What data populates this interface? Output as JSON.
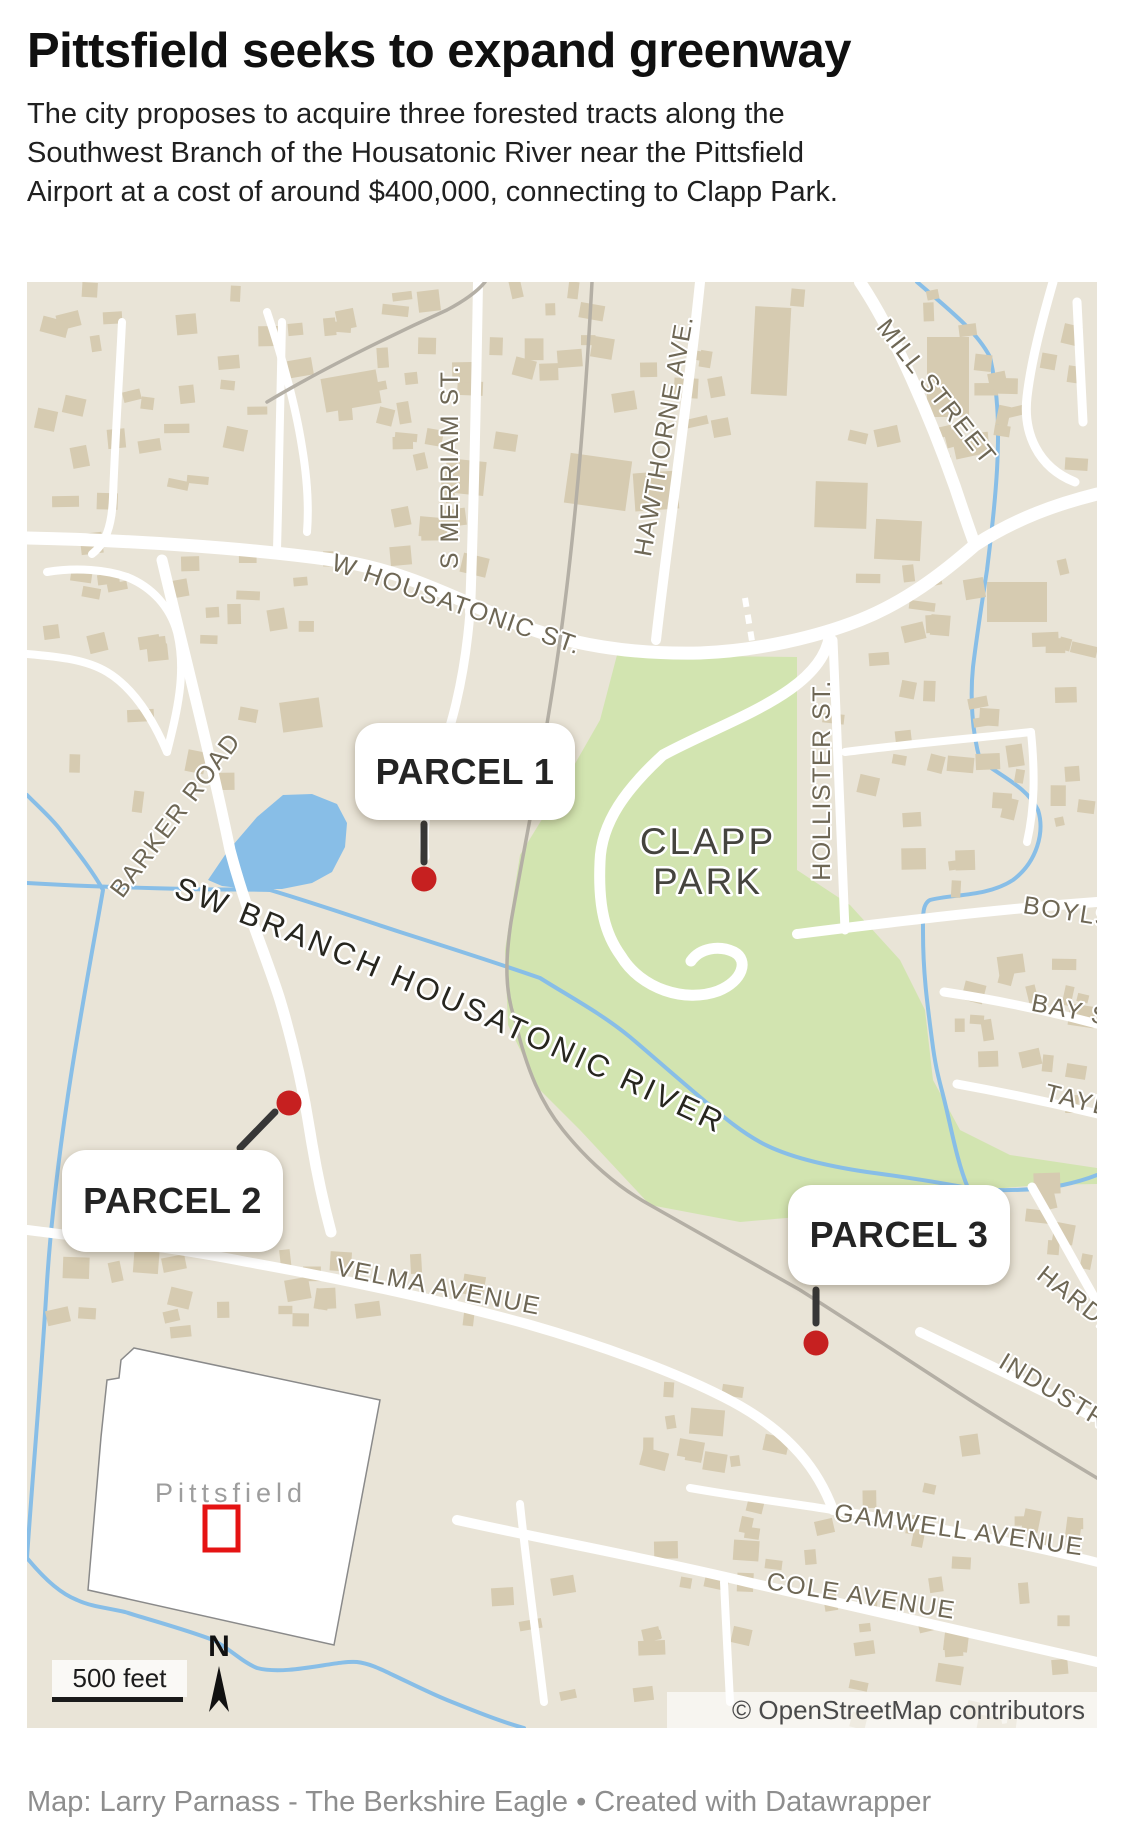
{
  "header": {
    "title": "Pittsfield seeks to expand greenway",
    "subtitle_lines": [
      "The city proposes to acquire three forested tracts along the",
      "Southwest Branch of the Housatonic River near the Pittsfield",
      "Airport at a cost of around $400,000, connecting to Clapp Park."
    ]
  },
  "map": {
    "street_labels": {
      "w_housatonic": "W HOUSATONIC ST.",
      "s_merriam": "S MERRIAM ST.",
      "hawthorne": "HAWTHORNE AVE.",
      "mill": "MILL STREET",
      "barker": "BARKER ROAD",
      "hollister": "HOLLISTER ST.",
      "boylston": "BOYLS",
      "bay": "BAY S",
      "taylor": "TAYL",
      "harding": "HARDI",
      "industrial": "INDUSTRI",
      "velma": "VELMA AVENUE",
      "gamwell": "GAMWELL AVENUE",
      "cole": "COLE AVENUE"
    },
    "area_labels": {
      "park_line1": "CLAPP",
      "park_line2": "PARK",
      "river": "SW BRANCH HOUSATONIC RIVER"
    },
    "parcels": [
      {
        "label": "PARCEL 1"
      },
      {
        "label": "PARCEL 2"
      },
      {
        "label": "PARCEL 3"
      }
    ],
    "inset": {
      "city_label": "Pittsfield"
    },
    "scale": {
      "label": "500 feet"
    },
    "compass": {
      "label": "N"
    },
    "attribution": "© OpenStreetMap contributors",
    "colors": {
      "map_background": "#e9e4d7",
      "building": "#d6cbb1",
      "park_green": "#d2e4b0",
      "water_blue": "#88bee7",
      "road_white": "#ffffff",
      "railroad_gray": "#b4afa5",
      "street_label": "#6e6755",
      "parcel_dot_red": "#c62020",
      "inset_marker_red": "#e51313"
    }
  },
  "footer": {
    "credit": "Map: Larry Parnass - The Berkshire Eagle • Created with Datawrapper"
  }
}
